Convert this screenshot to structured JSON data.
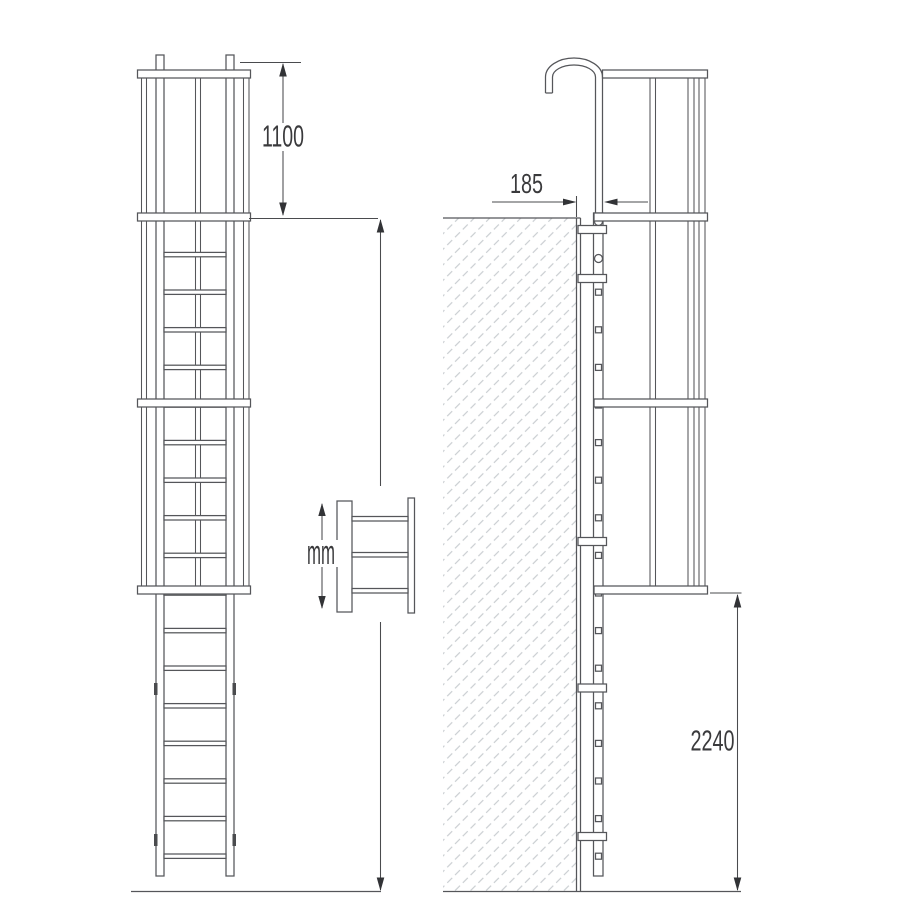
{
  "colors": {
    "background": "#ffffff",
    "line": "#55565a",
    "text": "#3a3a3c",
    "hatch": "#c9cdd1"
  },
  "dimensions": {
    "handrail_extension": {
      "label": "1100"
    },
    "wall_offset": {
      "label": "185"
    },
    "detail_unit": {
      "label": "mm"
    },
    "lower_height": {
      "label": "2240"
    }
  }
}
